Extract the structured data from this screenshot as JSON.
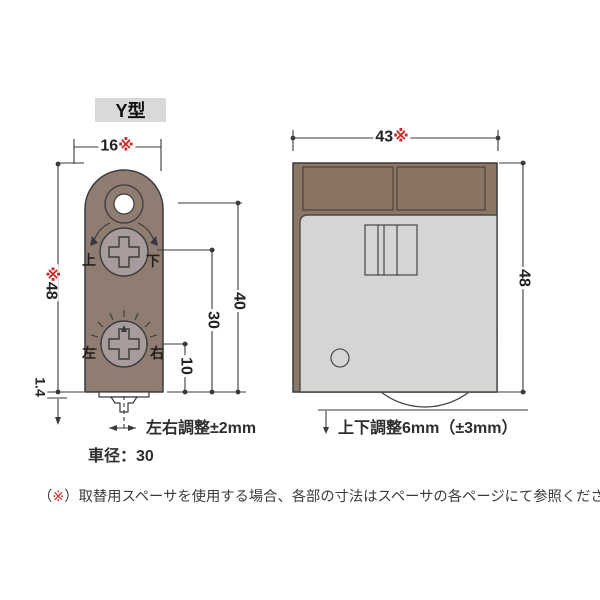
{
  "colors": {
    "accent_red": "#cc2a2a",
    "line_color": "#3a3a3c",
    "body_brown": "#8e7d70",
    "panel_brown": "#8a7464",
    "bar_brown": "#8c7767",
    "gray_body": "#d3d6d2",
    "screw_gray": "#a89b9c",
    "label_bg": "#d9d9d9",
    "text_color": "#3b3b3b"
  },
  "left_diagram": {
    "type_label": "Y型",
    "dims": {
      "width_value": "16",
      "width_marker": "※",
      "height_value": "48",
      "height_marker": "※",
      "d40": "40",
      "d30": "30",
      "d10": "10",
      "d1_4": "1.4"
    },
    "screw_labels": {
      "up": "上",
      "down": "下",
      "left": "左",
      "right": "右"
    },
    "adjust_note": "左右調整±2mm",
    "wheel_note": "車径：30"
  },
  "right_diagram": {
    "dims": {
      "width_value": "43",
      "width_marker": "※",
      "height_value": "48"
    },
    "adjust_note": "上下調整6mm（±3mm）"
  },
  "footnote": {
    "open": "（",
    "marker": "※",
    "close": "）",
    "text": "取替用スペーサを使用する場合、各部の寸法はスペーサの各ページにて参照ください。"
  }
}
